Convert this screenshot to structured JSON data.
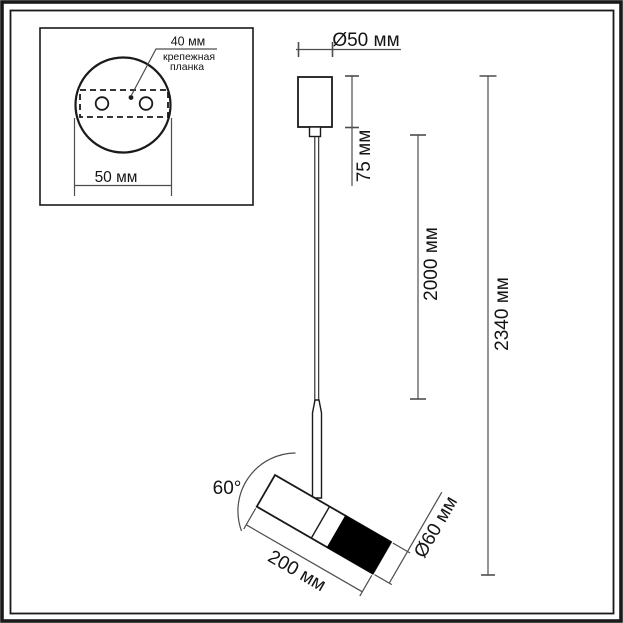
{
  "dimensions": {
    "canopy_diameter": "Ø50 мм",
    "canopy_height": "75 мм",
    "cord_length": "2000 мм",
    "total_height": "2340 мм",
    "spot_angle": "60°",
    "spot_length": "200 мм",
    "spot_diameter": "Ø60 мм"
  },
  "mount_inset": {
    "hole_pitch": "40 мм",
    "plate_label_line1": "крепежная",
    "plate_label_line2": "планка",
    "canopy_width": "50 мм"
  },
  "colors": {
    "outline": "#1a1a1a",
    "dimension_line": "#4d4d4d",
    "lamp_cap_fill": "#000000",
    "background": "#ffffff"
  }
}
